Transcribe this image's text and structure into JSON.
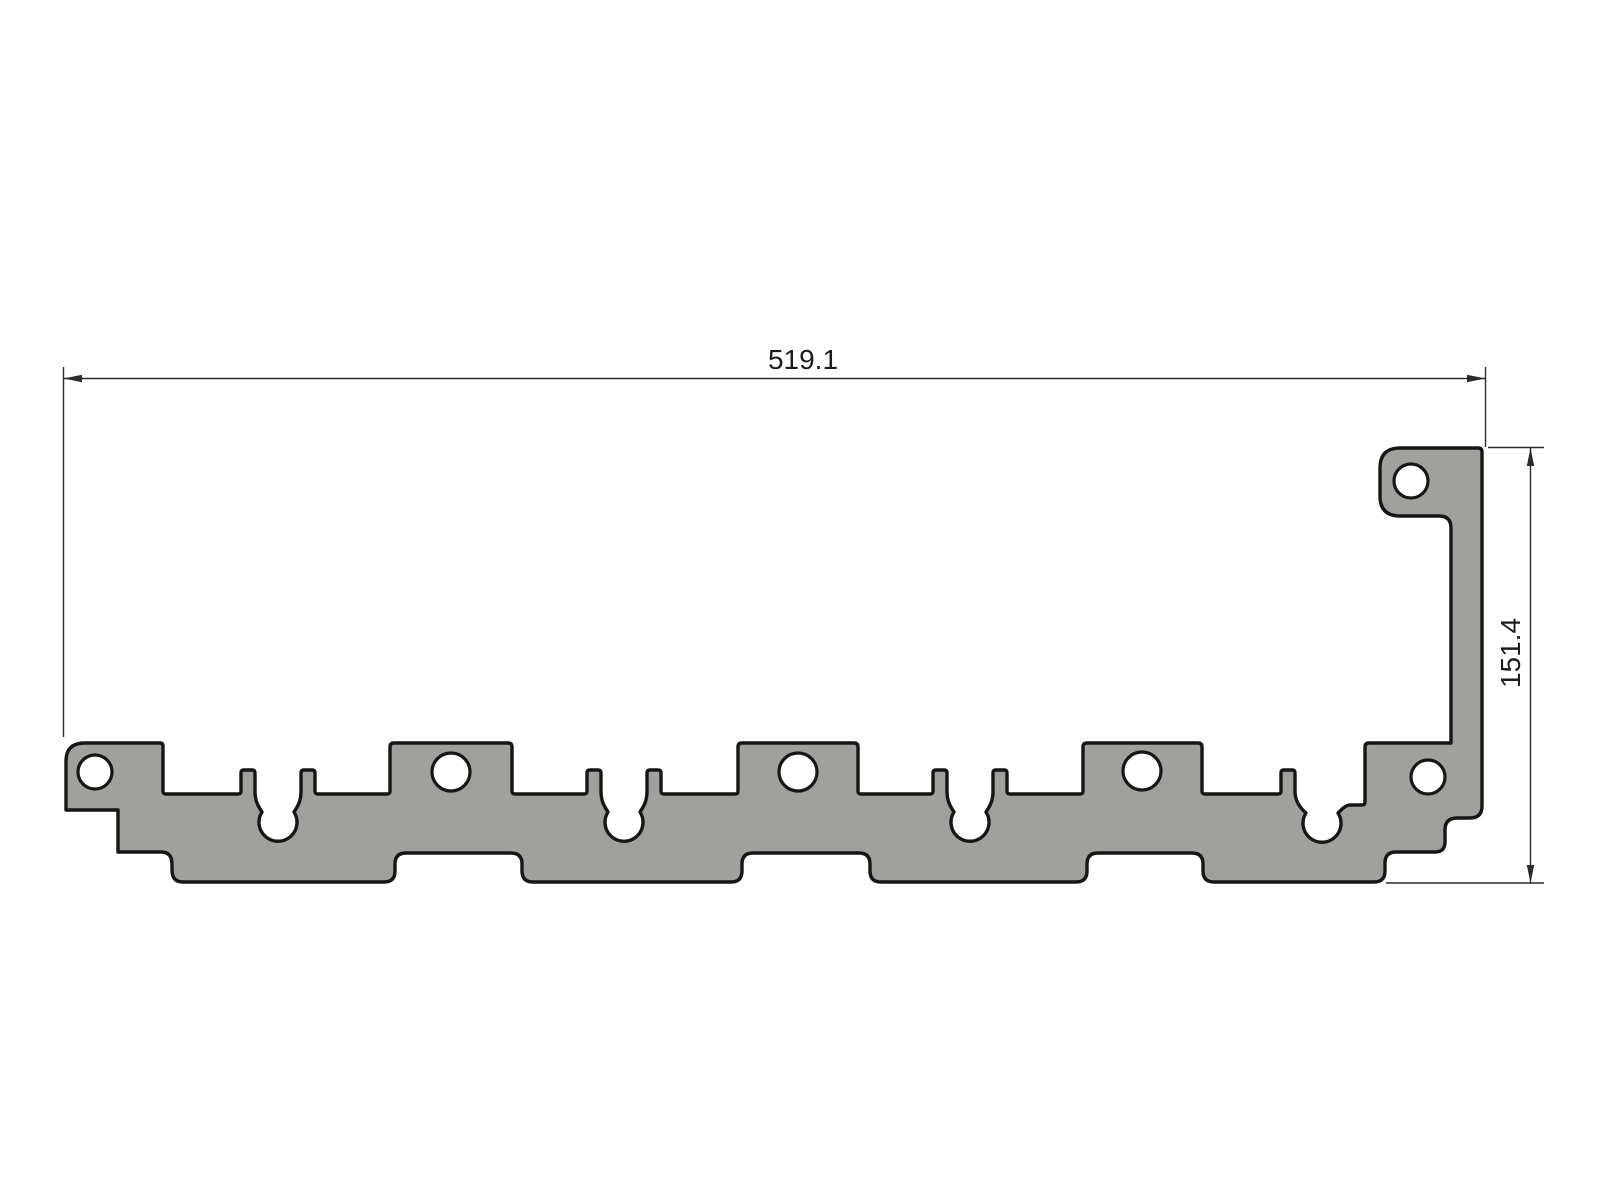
{
  "drawing": {
    "kind": "2D technical drawing of a stamped sheet-metal bracket profile",
    "dimensions": {
      "width": {
        "label": "519.1"
      },
      "height": {
        "label": "151.4"
      }
    },
    "colors": {
      "background": "#ffffff",
      "part_fill": "#a0a09c",
      "part_outline": "#161616",
      "dimension_line": "#2b2b2b",
      "dimension_text": "#1c1c1c"
    },
    "holes": [
      {
        "cx": 95,
        "cy": 772,
        "r": 17
      },
      {
        "cx": 451,
        "cy": 772,
        "r": 19
      },
      {
        "cx": 798,
        "cy": 772,
        "r": 19
      },
      {
        "cx": 1142,
        "cy": 771,
        "r": 19
      },
      {
        "cx": 1411,
        "cy": 481,
        "r": 17
      },
      {
        "cx": 1428,
        "cy": 777,
        "r": 17
      }
    ],
    "keyhole_slots": [
      {
        "cx": 278,
        "cy": 830,
        "r": 19
      },
      {
        "cx": 624,
        "cy": 830,
        "r": 19
      },
      {
        "cx": 970,
        "cy": 830,
        "r": 19
      },
      {
        "cx": 1322,
        "cy": 831,
        "r": 19
      }
    ]
  }
}
